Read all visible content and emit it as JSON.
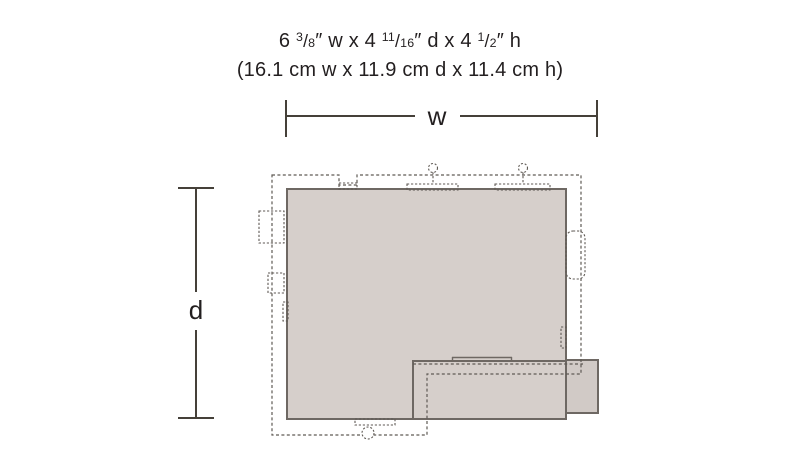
{
  "header": {
    "imperial": {
      "segments": [
        {
          "t": "6 ",
          "s": "n"
        },
        {
          "t": "3",
          "s": "sup"
        },
        {
          "t": "/",
          "s": "frac"
        },
        {
          "t": "8",
          "s": "den"
        },
        {
          "t": "″ w x 4 ",
          "s": "n"
        },
        {
          "t": "11",
          "s": "sup"
        },
        {
          "t": "/",
          "s": "frac"
        },
        {
          "t": "16",
          "s": "den"
        },
        {
          "t": "″ d x 4 ",
          "s": "n"
        },
        {
          "t": "1",
          "s": "sup"
        },
        {
          "t": "/",
          "s": "frac"
        },
        {
          "t": "2",
          "s": "den"
        },
        {
          "t": "″ h",
          "s": "n"
        }
      ]
    },
    "metric": "(16.1 cm w x 11.9 cm d x 11.4 cm h)"
  },
  "diagram": {
    "width_label": "w",
    "depth_label": "d",
    "colors": {
      "footprint_fill": "#d6cfcb",
      "annex_fill": "#d1cac6",
      "solid_outline": "#6e6863",
      "dashed_outline": "#5f5a55",
      "dimension_line": "#454039",
      "text": "#231f20"
    }
  }
}
